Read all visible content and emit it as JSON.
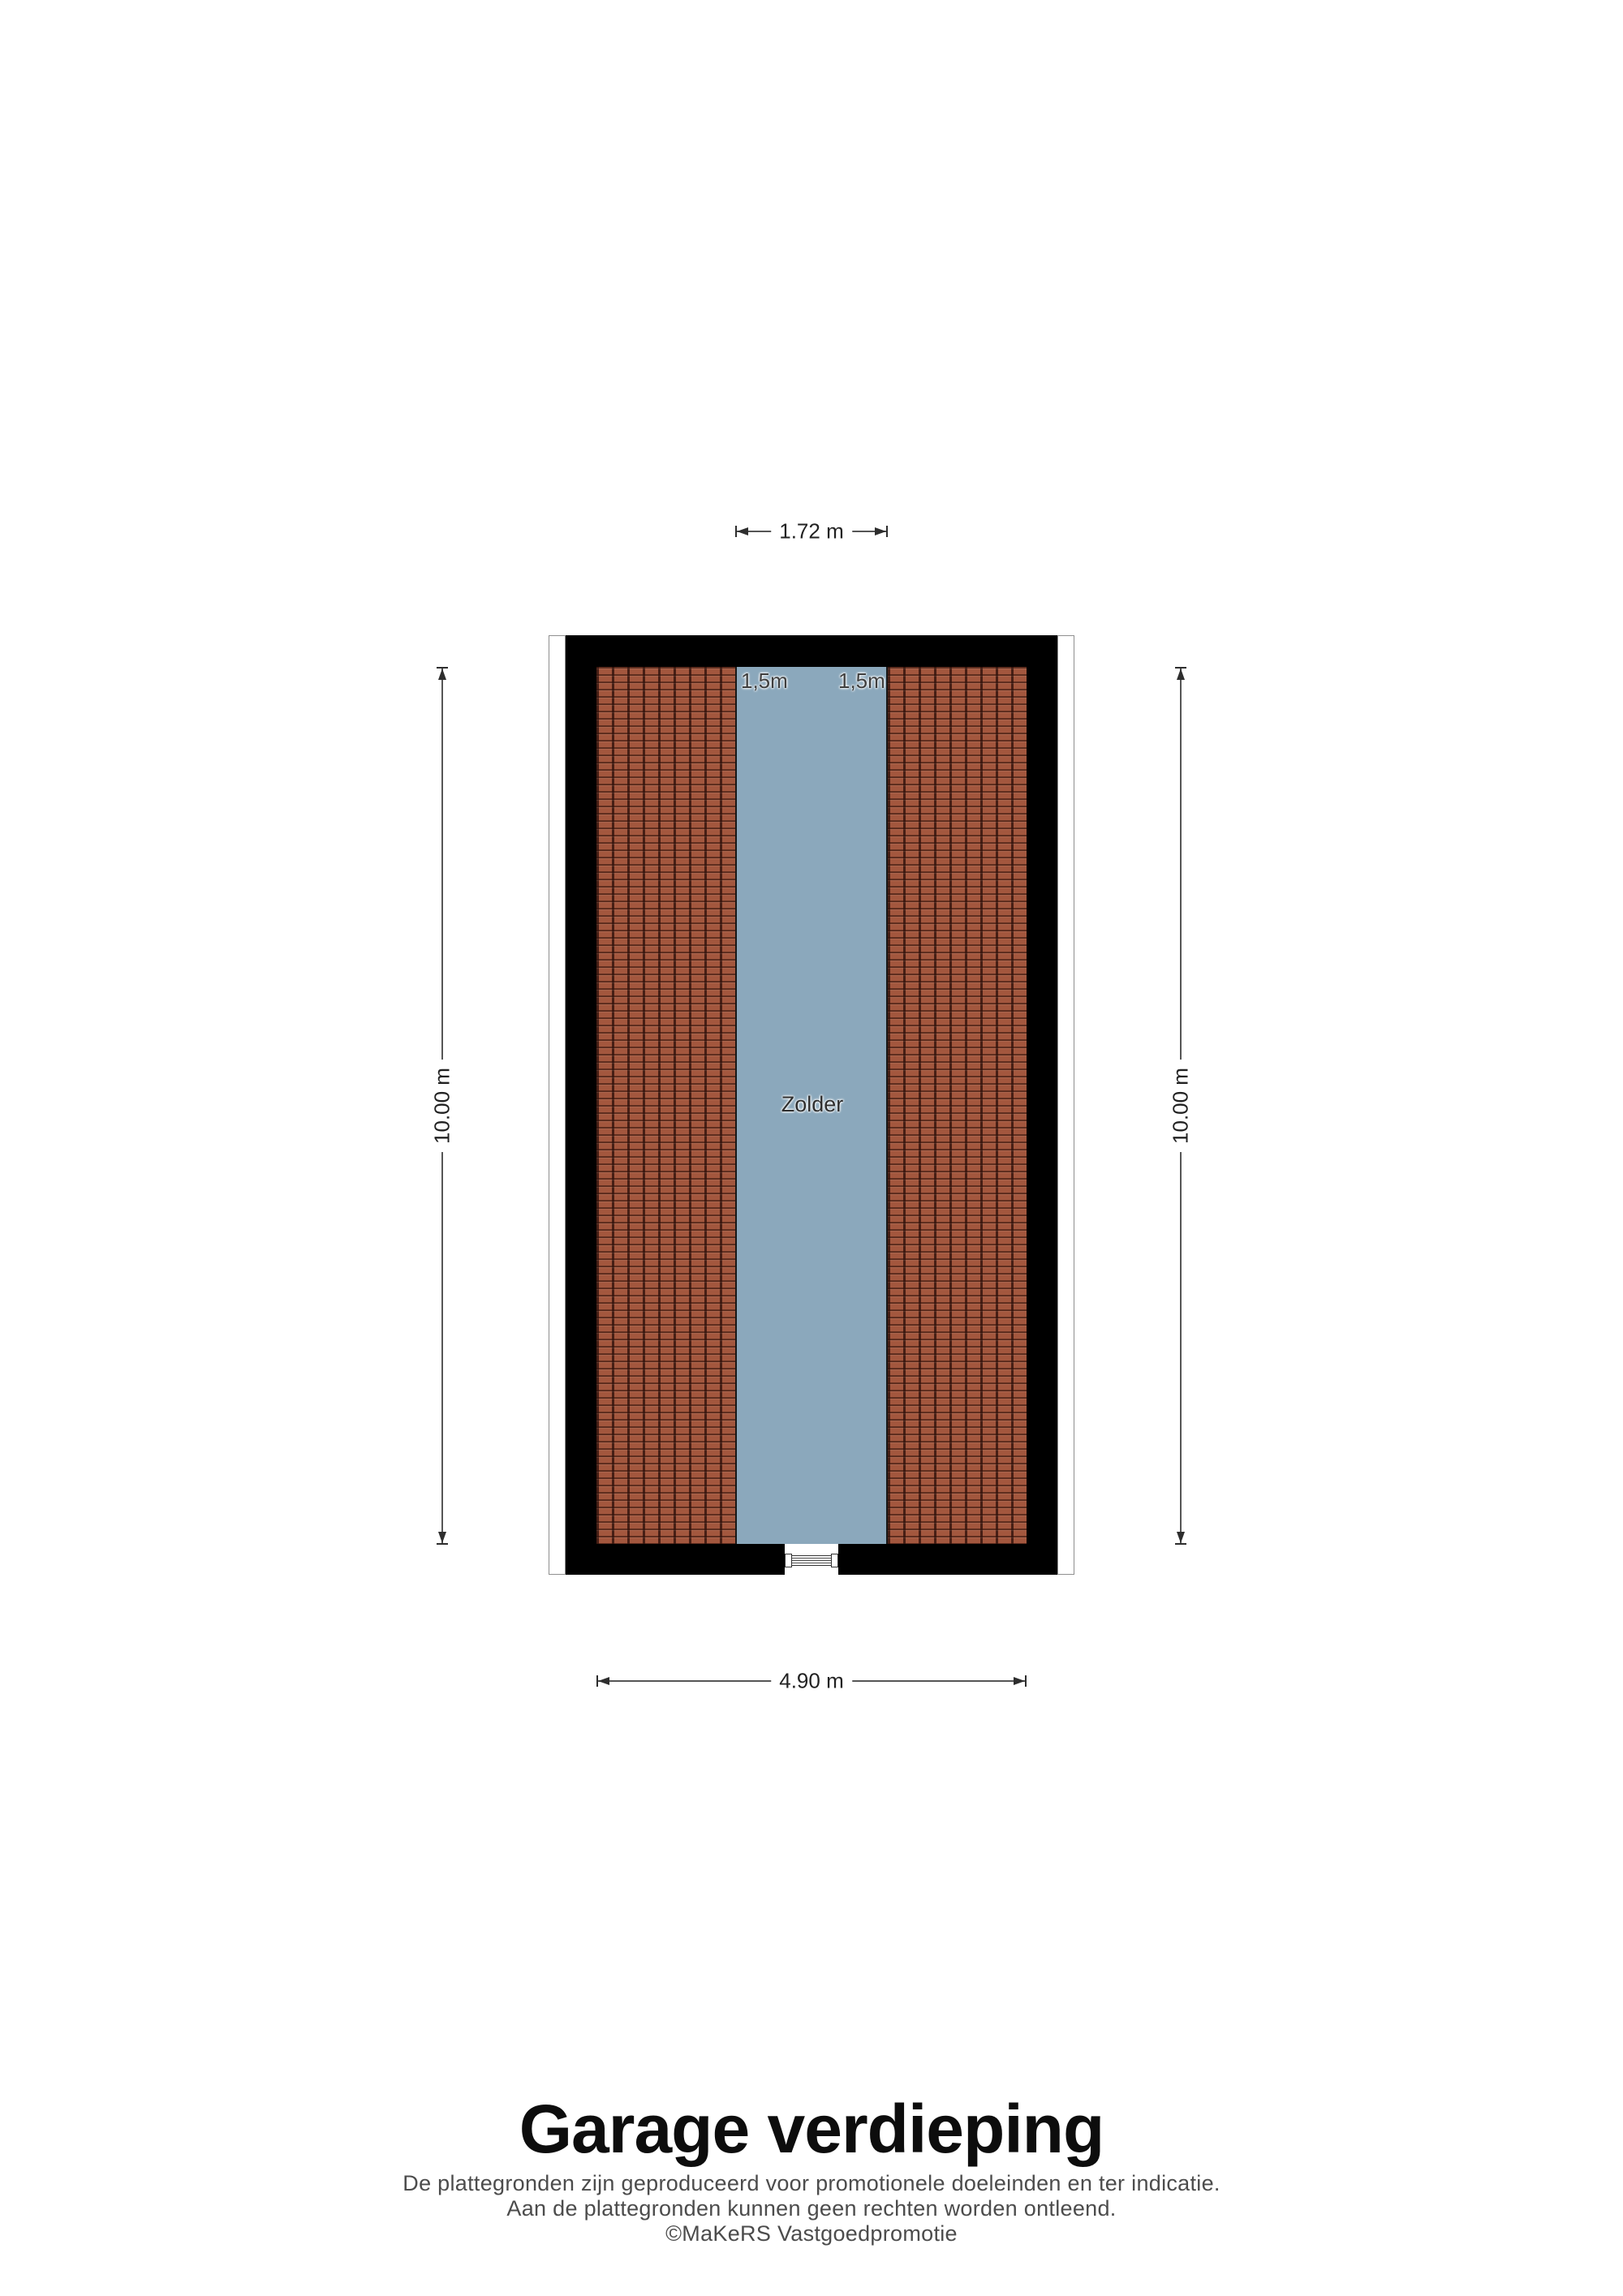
{
  "plan": {
    "room_label": "Zolder",
    "headroom_left": "1,5m",
    "headroom_right": "1,5m",
    "dimensions": {
      "top": "1.72 m",
      "left": "10.00 m",
      "right": "10.00 m",
      "bottom": "4.90 m"
    }
  },
  "footer": {
    "title": "Garage verdieping",
    "disclaimer_line1": "De plattegronden zijn geproduceerd voor promotionele doeleinden en ter indicatie.",
    "disclaimer_line2": "Aan de plattegronden kunnen geen rechten worden ontleend.",
    "copyright": "©MaKeRS Vastgoedpromotie"
  },
  "colors": {
    "wall": "#000000",
    "roof_tile": "#a3573e",
    "roof_tile_gap": "#471f15",
    "zolder_fill": "#8ba8bc",
    "dimension": "#2e2e2e",
    "footer_text": "#4c4c4c"
  }
}
